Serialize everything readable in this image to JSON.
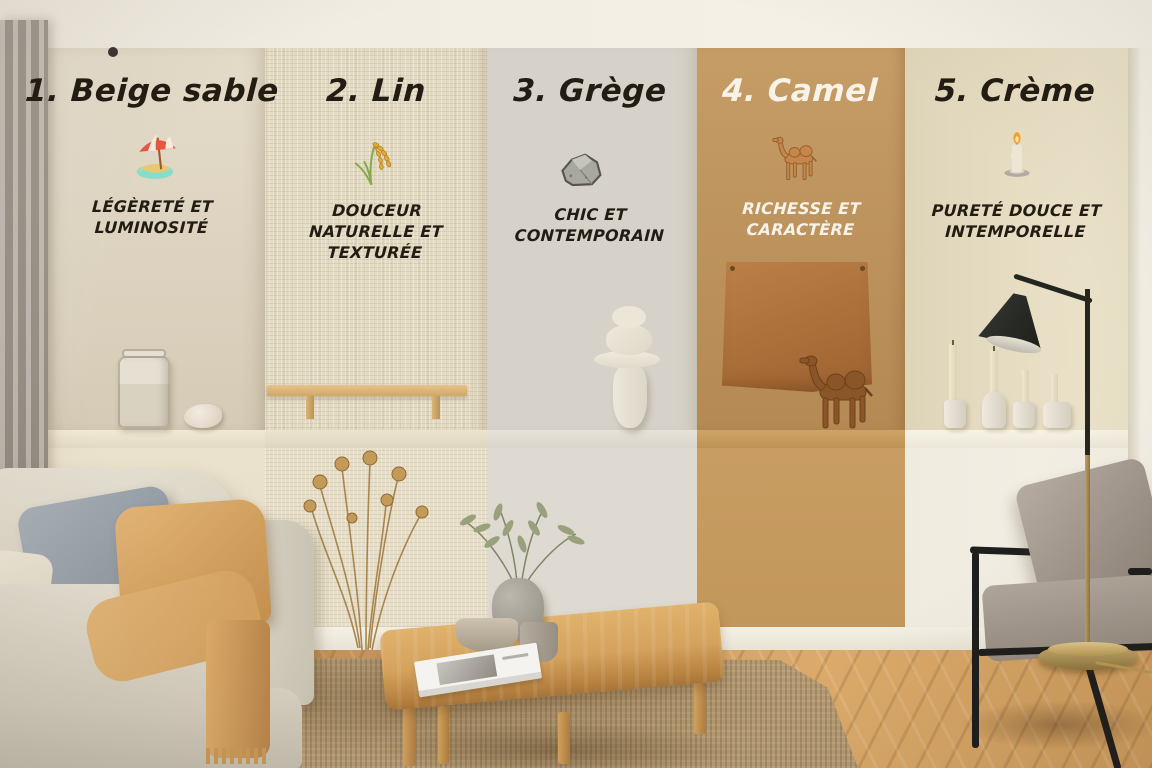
{
  "panels": [
    {
      "number": "1",
      "title": "1. Beige sable",
      "icon": "beach-umbrella-icon",
      "description": "LÉGÈRETÉ ET LUMINOSITÉ",
      "wall_color": "#dcd1bc",
      "text_color": "#221c13"
    },
    {
      "number": "2",
      "title": "2. Lin",
      "icon": "rice-sheaf-icon",
      "description": "DOUCEUR NATURELLE ET TEXTURÉE",
      "wall_color": "#e3dbc5",
      "text_color": "#221c13"
    },
    {
      "number": "3",
      "title": "3. Grège",
      "icon": "rock-icon",
      "description": "CHIC ET CONTEMPORAIN",
      "wall_color": "#d6d2c9",
      "text_color": "#221c13"
    },
    {
      "number": "4",
      "title": "4. Camel",
      "icon": "camel-icon",
      "description": "RICHESSE ET CARACTÈRE",
      "wall_color": "#c0935a",
      "text_color": "#f8f3e9"
    },
    {
      "number": "5",
      "title": "5. Crème",
      "icon": "candle-icon",
      "description": "PURETÉ DOUCE ET INTEMPORELLE",
      "wall_color": "#e7ddc0",
      "text_color": "#221c13"
    }
  ],
  "scene": {
    "objects": [
      "curtain",
      "linen-sofa",
      "blue-gray-cushion",
      "camel-throw-blanket",
      "dried-flowers",
      "wooden-wall-shelf",
      "sand-jar",
      "seashell",
      "stone-stack-sculpture",
      "leather-wall-hanging",
      "wooden-camel-figurine",
      "taper-candles",
      "black-floor-lamp",
      "oak-coffee-table",
      "olive-branch-vase",
      "magazine",
      "jute-rug",
      "herringbone-floor",
      "gray-armchair"
    ]
  }
}
